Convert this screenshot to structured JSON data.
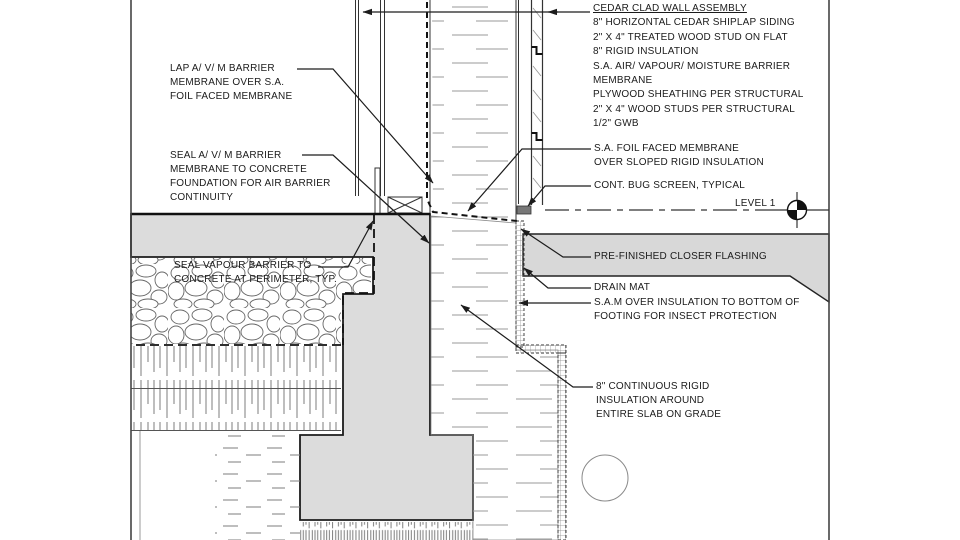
{
  "drawing": {
    "type_note": "foundation wall construction detail",
    "colors": {
      "concrete": "#dcdcdc",
      "grade_fill": "#d8d8d8",
      "line": "#1c1c1c",
      "hatch": "#8c8c8c",
      "bug_screen": "#787878"
    },
    "level_marker": {
      "label": "LEVEL 1",
      "icon": "level-datum-target"
    },
    "cedar_assembly": {
      "heading": "CEDAR CLAD WALL ASSEMBLY",
      "lines": [
        "8\" HORIZONTAL CEDAR SHIPLAP SIDING",
        "2\" X 4\" TREATED WOOD STUD ON FLAT",
        "8\" RIGID INSULATION",
        "S.A. AIR/ VAPOUR/ MOISTURE BARRIER",
        "MEMBRANE",
        "PLYWOOD SHEATHING PER STRUCTURAL",
        "2\" X 4\" WOOD STUDS PER STRUCTURAL",
        "1/2\" GWB"
      ]
    },
    "callouts": {
      "lap_barrier": {
        "lines": [
          "LAP A/ V/ M BARRIER",
          "MEMBRANE OVER S.A.",
          "FOIL FACED MEMBRANE"
        ]
      },
      "seal_barrier": {
        "lines": [
          "SEAL A/ V/ M BARRIER",
          "MEMBRANE TO CONCRETE",
          "FOUNDATION FOR AIR BARRIER",
          "CONTINUITY"
        ]
      },
      "seal_vapour": {
        "lines": [
          "SEAL VAPOUR BARRIER TO",
          "CONCRETE AT PERIMETER, TYP."
        ]
      },
      "foil_membrane": {
        "lines": [
          "S.A. FOIL FACED MEMBRANE",
          "OVER SLOPED RIGID INSULATION"
        ]
      },
      "bug_screen": {
        "lines": [
          "CONT. BUG SCREEN, TYPICAL"
        ]
      },
      "flashing": {
        "lines": [
          "PRE-FINISHED CLOSER FLASHING"
        ]
      },
      "drain_mat": {
        "lines": [
          "DRAIN MAT"
        ]
      },
      "sam_insect": {
        "lines": [
          "S.A.M OVER INSULATION TO BOTTOM OF",
          "FOOTING FOR INSECT PROTECTION"
        ]
      },
      "rigid_insulation": {
        "lines": [
          "8\" CONTINUOUS RIGID",
          "INSULATION AROUND",
          "ENTIRE SLAB ON GRADE"
        ]
      }
    }
  }
}
